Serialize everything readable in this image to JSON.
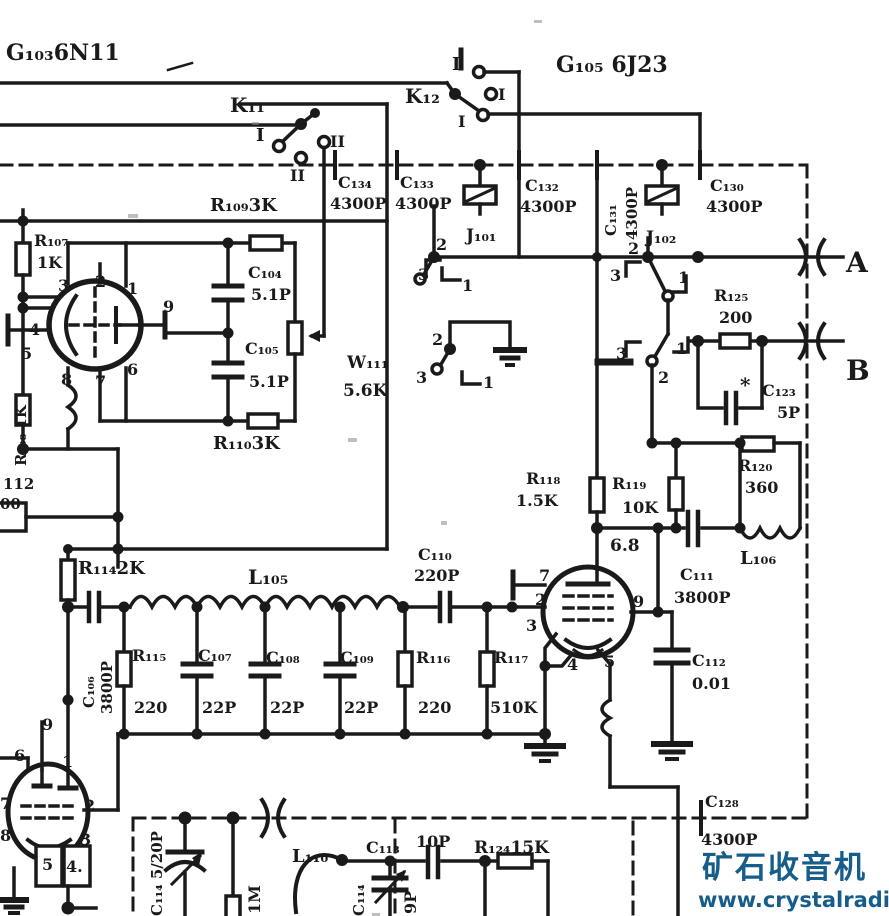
{
  "colors": {
    "ink": "#1a1a1a",
    "paper": "#ffffff",
    "watermark": "#175d8c"
  },
  "tubes": {
    "g103": "G₁₀₃6N11",
    "g105": "G₁₀₅ 6J23",
    "g103_pins": {
      "p3": "3",
      "p2": "2",
      "p1": "1",
      "p9": "9",
      "p4": "4",
      "p5": "5",
      "p8": "8",
      "p7": "7",
      "p6": "6"
    },
    "g105_pins": {
      "p7": "7",
      "p2": "2",
      "p9": "9",
      "p3": "3",
      "p4": "4",
      "p5": "5"
    },
    "g104_pins": {
      "p9": "9",
      "p6": "6",
      "p1": "1",
      "p7": "7",
      "p2": "2",
      "p8": "8",
      "p3": "3",
      "p5": "5",
      "p4": "4."
    }
  },
  "switches": {
    "k11": "K₁₁",
    "k11_pos_i": "I",
    "k11_pos_ii": "II",
    "k11_pos_ii2": "II",
    "k12": "K₁₂",
    "k12_pos_i_top": "I",
    "k12_pos_i_mid": "I",
    "k12_pos_i_bot": "I"
  },
  "relays": {
    "j101": "J₁₀₁",
    "j101_c2": "2",
    "j101_c3": "3",
    "j101_c1": "1",
    "j101b_c2": "2",
    "j101b_c3": "3",
    "j101b_c1": "1",
    "j102": "J₁₀₂",
    "j102_c2": "2",
    "j102_c3": "3",
    "j102_c1": "1",
    "j102b_c3": "3",
    "j102b_c1": "1",
    "j102b_c2": "2"
  },
  "connectors": {
    "a": "A",
    "b": "B"
  },
  "components": {
    "c134": "C₁₃₄",
    "c134_v": "4300P",
    "c133": "C₁₃₃",
    "c133_v": "4300P",
    "c132": "C₁₃₂",
    "c132_v": "4300P",
    "c131": "C₁₃₁",
    "c131_v": "4300P",
    "c130": "C₁₃₀",
    "c130_v": "4300P",
    "c128": "C₁₂₈",
    "c128_v": "4300P",
    "r107": "R₁₀₇",
    "r107_v": "1K",
    "r108": "R₁₀₈ 1K",
    "r109": "R₁₀₉3K",
    "r110": "R₁₁₀3K",
    "c104": "C₁₀₄",
    "c104_v": "5.1P",
    "c105": "C₁₀₅",
    "c105_v": "5.1P",
    "w111": "W₁₁₁",
    "w111_v": "5.6K",
    "w112_partial_a": "112",
    "w112_partial_b": "00",
    "r114": "R₁₁₄2K",
    "c106": "C₁₀₆",
    "c106_v": "3800P",
    "l105": "L₁₀₅",
    "r115": "R₁₁₅",
    "r115_v": "220",
    "c107": "C₁₀₇",
    "c107_v": "22P",
    "c108": "C₁₀₈",
    "c108_v": "22P",
    "c109": "C₁₀₉",
    "c109_v": "22P",
    "r116": "R₁₁₆",
    "r116_v": "220",
    "r117": "R₁₁₇",
    "r117_v": "510K",
    "c110": "C₁₁₀",
    "c110_v": "220P",
    "r118": "R₁₁₈",
    "r118_v": "1.5K",
    "r119": "R₁₁₉",
    "r119_v": "10K",
    "bias": "6.8",
    "c111": "C₁₁₁",
    "c111_v": "3800P",
    "c112": "C₁₁₂",
    "c112_v": "0.01",
    "r120": "R₁₂₀",
    "r120_v": "360",
    "l106": "L₁₀₆",
    "r125": "R₁₂₅",
    "r125_v": "200",
    "c123": "C₁₂₃",
    "c123_v": "5P",
    "c123_mark": "*",
    "c114a": "C₁₁₄ 5/20P",
    "r_1m": "1M",
    "l110": "L₁₁₀",
    "c113": "C₁₁₃",
    "c113_v": "10P",
    "r124": "R₁₂₄15K",
    "c114b": "C₁₁₄",
    "c114b_v": "9P"
  },
  "watermark": {
    "cn": "矿石收音机",
    "url": "www.crystalradio.cn"
  }
}
